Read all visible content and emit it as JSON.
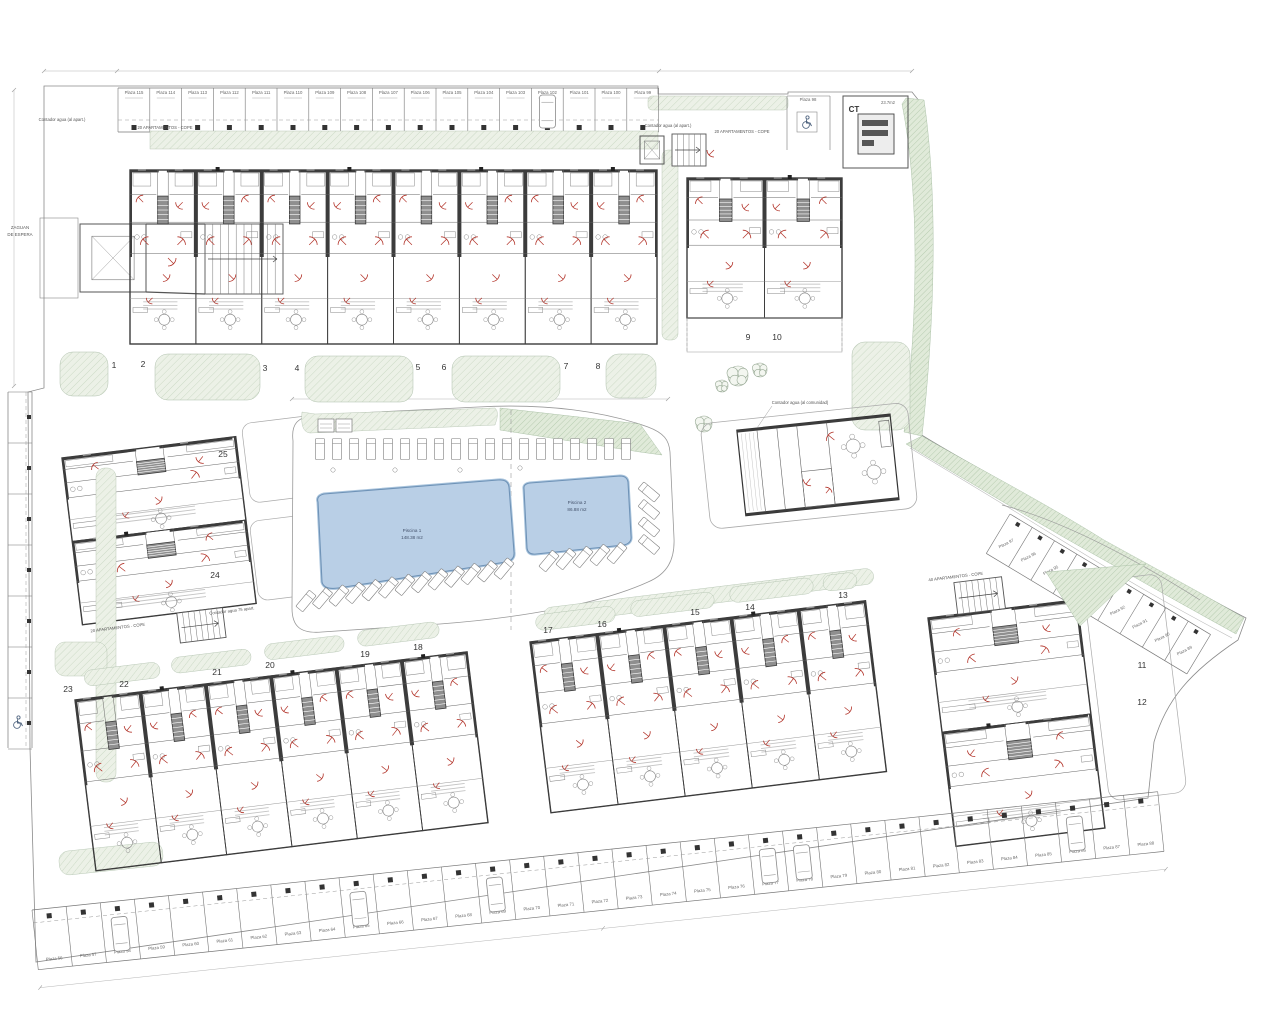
{
  "plan": {
    "transformer": {
      "label": "CT",
      "area": "23.7m2"
    },
    "entrance": {
      "line1": "ZAGUAN",
      "line2": "DE ESPERA"
    },
    "annotations": [
      {
        "text": "20 APARTAMENTOS - COPE"
      },
      {
        "text": "20 APARTAMENTOS - COPE"
      },
      {
        "text": "20 APARTAMENTOS - COPE"
      },
      {
        "text": "40 APARTAMENTOS - COPE"
      },
      {
        "text": "Contador agua (al apart.)"
      },
      {
        "text": "Contador agua (al apart.)"
      },
      {
        "text": "Contador agua (al comunidad)"
      },
      {
        "text": "Contador agua 75 apart."
      }
    ],
    "pools": [
      {
        "label": "Piscina 1",
        "area": "148.38 m2"
      },
      {
        "label": "Piscina 2",
        "area": "86.88 m2"
      }
    ],
    "units": [
      {
        "label": "1",
        "x": 114,
        "y": 368
      },
      {
        "label": "2",
        "x": 143,
        "y": 367
      },
      {
        "label": "3",
        "x": 265,
        "y": 371
      },
      {
        "label": "4",
        "x": 297,
        "y": 371
      },
      {
        "label": "5",
        "x": 418,
        "y": 370
      },
      {
        "label": "6",
        "x": 444,
        "y": 370
      },
      {
        "label": "7",
        "x": 566,
        "y": 369
      },
      {
        "label": "8",
        "x": 598,
        "y": 369
      },
      {
        "label": "9",
        "x": 748,
        "y": 340
      },
      {
        "label": "10",
        "x": 777,
        "y": 340
      },
      {
        "label": "11",
        "x": 1142,
        "y": 668
      },
      {
        "label": "12",
        "x": 1142,
        "y": 705
      },
      {
        "label": "13",
        "x": 843,
        "y": 598
      },
      {
        "label": "14",
        "x": 750,
        "y": 610
      },
      {
        "label": "15",
        "x": 695,
        "y": 615
      },
      {
        "label": "16",
        "x": 602,
        "y": 627
      },
      {
        "label": "17",
        "x": 548,
        "y": 633
      },
      {
        "label": "18",
        "x": 418,
        "y": 650
      },
      {
        "label": "19",
        "x": 365,
        "y": 657
      },
      {
        "label": "20",
        "x": 270,
        "y": 668
      },
      {
        "label": "21",
        "x": 217,
        "y": 675
      },
      {
        "label": "22",
        "x": 124,
        "y": 687
      },
      {
        "label": "23",
        "x": 68,
        "y": 692
      },
      {
        "label": "24",
        "x": 215,
        "y": 578
      },
      {
        "label": "25",
        "x": 223,
        "y": 457
      }
    ],
    "parking": {
      "accessible": "Plaza 98",
      "top_row": [
        "Plaza 115",
        "Plaza 114",
        "Plaza 113",
        "Plaza 112",
        "Plaza 111",
        "Plaza 110",
        "Plaza 109",
        "Plaza 108",
        "Plaza 107",
        "Plaza 106",
        "Plaza 105",
        "Plaza 104",
        "Plaza 103",
        "Plaza 102",
        "Plaza 101",
        "Plaza 100",
        "Plaza 99"
      ],
      "right_road": [
        "Plaza 97",
        "Plaza 96",
        "Plaza 95",
        "Plaza 94",
        "Plaza 93",
        "Plaza 92",
        "Plaza 91",
        "Plaza 90",
        "Plaza 89"
      ],
      "bottom_row": [
        "Plaza 56",
        "Plaza 57",
        "Plaza 58",
        "Plaza 59",
        "Plaza 60",
        "Plaza 61",
        "Plaza 62",
        "Plaza 63",
        "Plaza 64",
        "Plaza 65",
        "Plaza 66",
        "Plaza 67",
        "Plaza 68",
        "Plaza 69",
        "Plaza 70",
        "Plaza 71",
        "Plaza 72",
        "Plaza 73",
        "Plaza 74",
        "Plaza 75",
        "Plaza 76",
        "Plaza 77",
        "Plaza 78",
        "Plaza 79",
        "Plaza 80",
        "Plaza 81",
        "Plaza 82",
        "Plaza 83",
        "Plaza 84",
        "Plaza 85",
        "Plaza 86",
        "Plaza 87",
        "Plaza 88"
      ]
    },
    "colors": {
      "pool_fill": "#b9cfe6",
      "pool_edge": "#6f93b7",
      "green_light": "#ecf1e7",
      "green_dense": "#e0ead9",
      "red_arc": "#b23228",
      "wall": "#3c3c3c"
    }
  }
}
